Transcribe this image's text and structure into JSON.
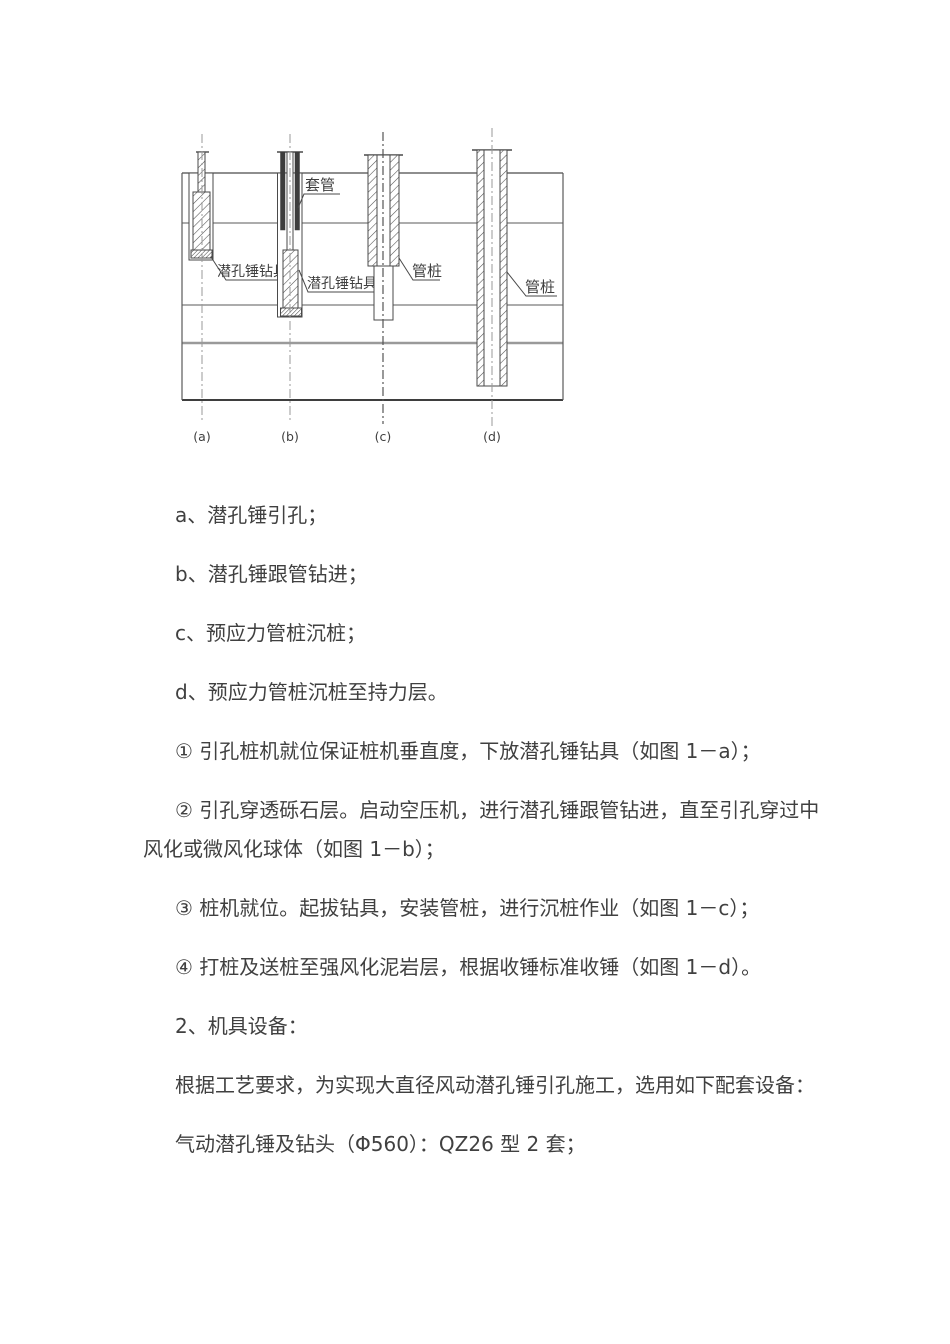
{
  "colors": {
    "text": "#404040",
    "line": "#4a4a4a",
    "gray_layer": "#9a9a9a",
    "centerline": "#999999"
  },
  "figure": {
    "labels": {
      "casing": "套管",
      "drill_a": "潜孔锤钻具",
      "drill_b": "潜孔锤钻具",
      "pile_c": "管桩",
      "pile_d": "管桩"
    },
    "captions": {
      "a": "(a)",
      "b": "(b)",
      "c": "(c)",
      "d": "(d)"
    }
  },
  "paragraphs": [
    {
      "lines": [
        "a、潜孔锤引孔；"
      ]
    },
    {
      "lines": [
        "b、潜孔锤跟管钻进；"
      ]
    },
    {
      "lines": [
        "c、预应力管桩沉桩；"
      ]
    },
    {
      "lines": [
        "d、预应力管桩沉桩至持力层。"
      ]
    },
    {
      "lines": [
        "① 引孔桩机就位保证桩机垂直度，下放潜孔锤钻具（如图 1－a）；"
      ]
    },
    {
      "lines": [
        "② 引孔穿透砾石层。启动空压机，进行潜孔锤跟管钻进，直至引孔穿过中",
        "风化或微风化球体（如图 1－b）；"
      ]
    },
    {
      "lines": [
        "③ 桩机就位。起拔钻具，安装管桩，进行沉桩作业（如图 1－c）；"
      ]
    },
    {
      "lines": [
        "④ 打桩及送桩至强风化泥岩层，根据收锤标准收锤（如图 1－d）。"
      ]
    },
    {
      "lines": [
        "2、机具设备："
      ]
    },
    {
      "lines": [
        "根据工艺要求，为实现大直径风动潜孔锤引孔施工，选用如下配套设备："
      ]
    },
    {
      "lines": [
        "气动潜孔锤及钻头（Φ560）：QZ26 型 2 套；"
      ]
    }
  ]
}
